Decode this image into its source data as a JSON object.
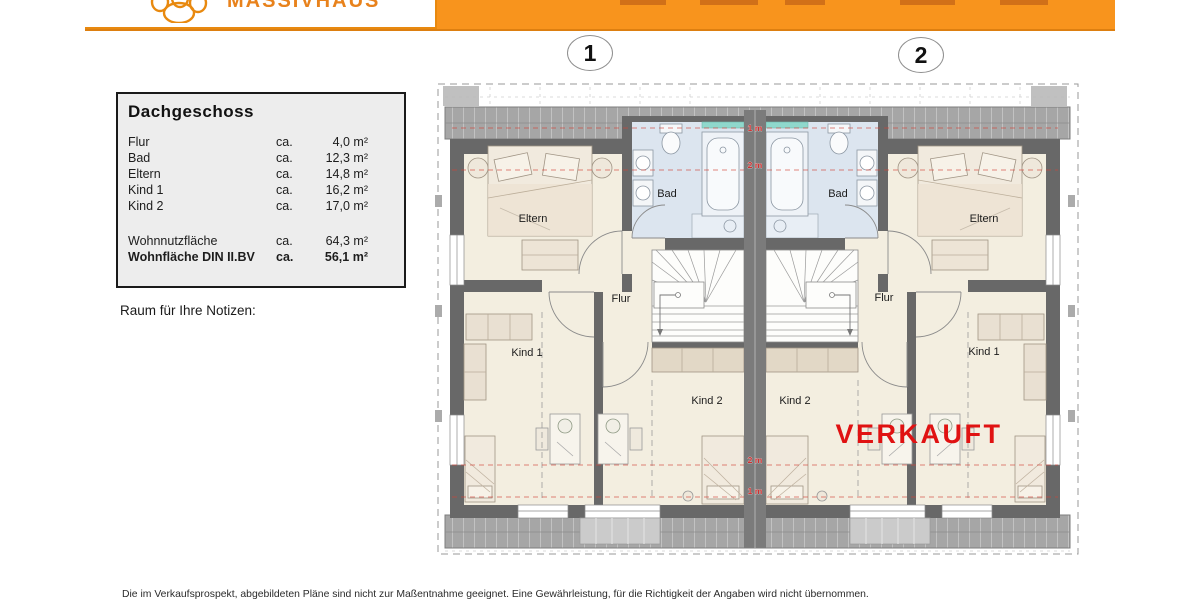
{
  "header": {
    "brand": "MASSIVHAUS",
    "bar_color": "#F8941D"
  },
  "unit_markers": {
    "left": "1",
    "right": "2"
  },
  "legend": {
    "title": "Dachgeschoss",
    "rows": [
      {
        "label": "Flur",
        "approx": "ca.",
        "value": "4,0 m²"
      },
      {
        "label": "Bad",
        "approx": "ca.",
        "value": "12,3 m²"
      },
      {
        "label": "Eltern",
        "approx": "ca.",
        "value": "14,8 m²"
      },
      {
        "label": "Kind 1",
        "approx": "ca.",
        "value": "16,2 m²"
      },
      {
        "label": "Kind 2",
        "approx": "ca.",
        "value": "17,0 m²"
      }
    ],
    "totals": [
      {
        "label": "Wohnnutzfläche",
        "approx": "ca.",
        "value": "64,3 m²"
      },
      {
        "label": "Wohnfläche DIN II.BV",
        "approx": "ca.",
        "value": "56,1 m²"
      }
    ]
  },
  "notes_label": "Raum für Ihre Notizen:",
  "plan": {
    "room_labels": [
      "Eltern",
      "Bad",
      "Flur",
      "Kind 1",
      "Kind 2",
      "Bad",
      "Eltern",
      "Flur",
      "Kind 2",
      "Kind 1"
    ],
    "height_marks": [
      "1 m",
      "2 m",
      "2 m",
      "1 m"
    ],
    "sold_stamp": "VERKAUFT",
    "sold_color": "#E01212"
  },
  "footer": {
    "disclaimer": "Die im Verkaufsprospekt, abgebildeten Pläne sind nicht zur Maßentnahme geeignet. Eine Gewährleistung, für die Richtigkeit der Angaben wird nicht übernommen."
  }
}
